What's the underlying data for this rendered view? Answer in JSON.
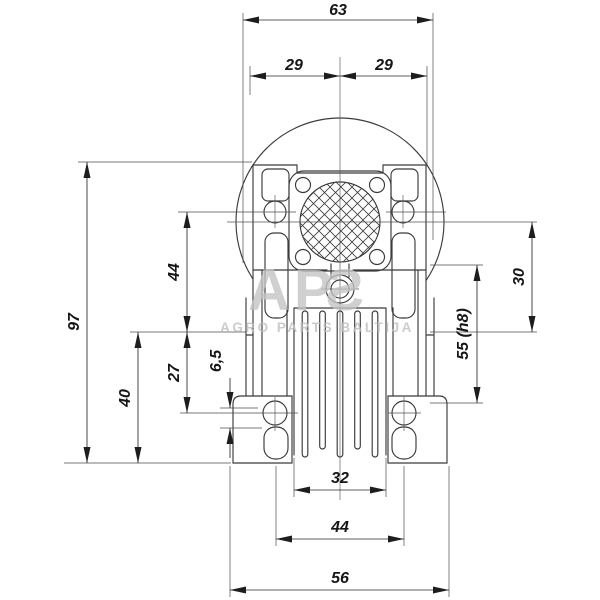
{
  "drawing_title": "Gearbox housing front view dimensional drawing",
  "watermark": {
    "logo_ap": "AP",
    "logo_s": "S",
    "subtitle": "AGRO PARTS BALTIJA"
  },
  "dims": {
    "d63": "63",
    "d29l": "29",
    "d29r": "29",
    "d97": "97",
    "d44_left": "44",
    "d40": "40",
    "d27": "27",
    "d6_5": "6,5",
    "d30": "30",
    "d55": "55 (h8)",
    "d32": "32",
    "d44_bottom": "44",
    "d56": "56"
  },
  "colors": {
    "line": "#3b3b3b",
    "dim_text": "#161616",
    "watermark": "#c4c4c4",
    "background": "#ffffff"
  }
}
